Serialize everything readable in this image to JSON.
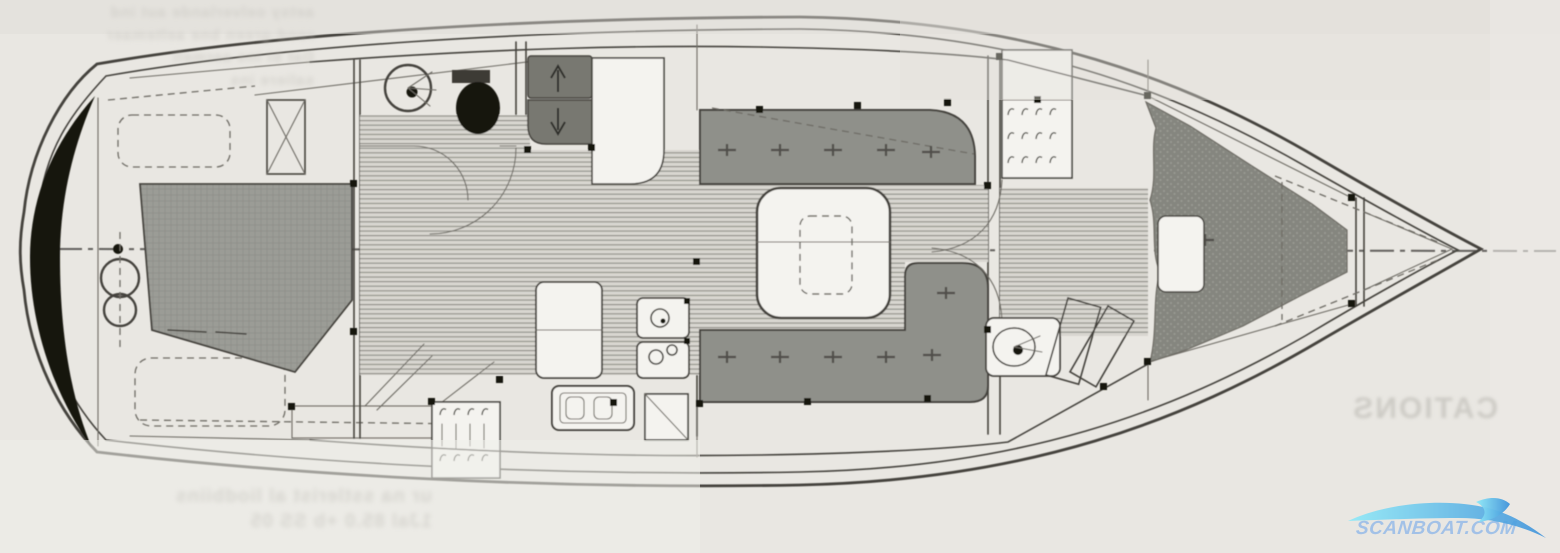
{
  "diagram": {
    "watermark": {
      "text": "SCANBOAT.COM"
    },
    "bleed_through": {
      "top_left_lines": "aetsy oelverlande aut ind\nrood-green bne aeltemaer\nDat bi ins aermeli\nsaliere ins",
      "bottom_left_line1": "ur na sstlerist al liodbiins",
      "bottom_left_line2": "1Jal 85.0         +b SS 05",
      "right_mirrored_word": "CATIONS"
    },
    "palette": {
      "paper": "#e9e7e2",
      "paperDark": "#dddbd6",
      "paperLight": "#efeeea",
      "ink": "#45433d",
      "inkLight": "#6e6c65",
      "sole": "#d8d6d0",
      "soleLine": "#8b8a83",
      "cushion": "#8f908a",
      "berth": "#9b9c96",
      "berthLine": "#8f9089",
      "tex": "#85867f",
      "texDot": "#9a9b94",
      "panel": "#787871",
      "black": "#17160f",
      "white": "#f4f3ef",
      "bleed": "#c6c4be",
      "wmText": "#9fc0e8",
      "waveA": "#8ee9f8",
      "waveB": "#3f92da"
    }
  }
}
